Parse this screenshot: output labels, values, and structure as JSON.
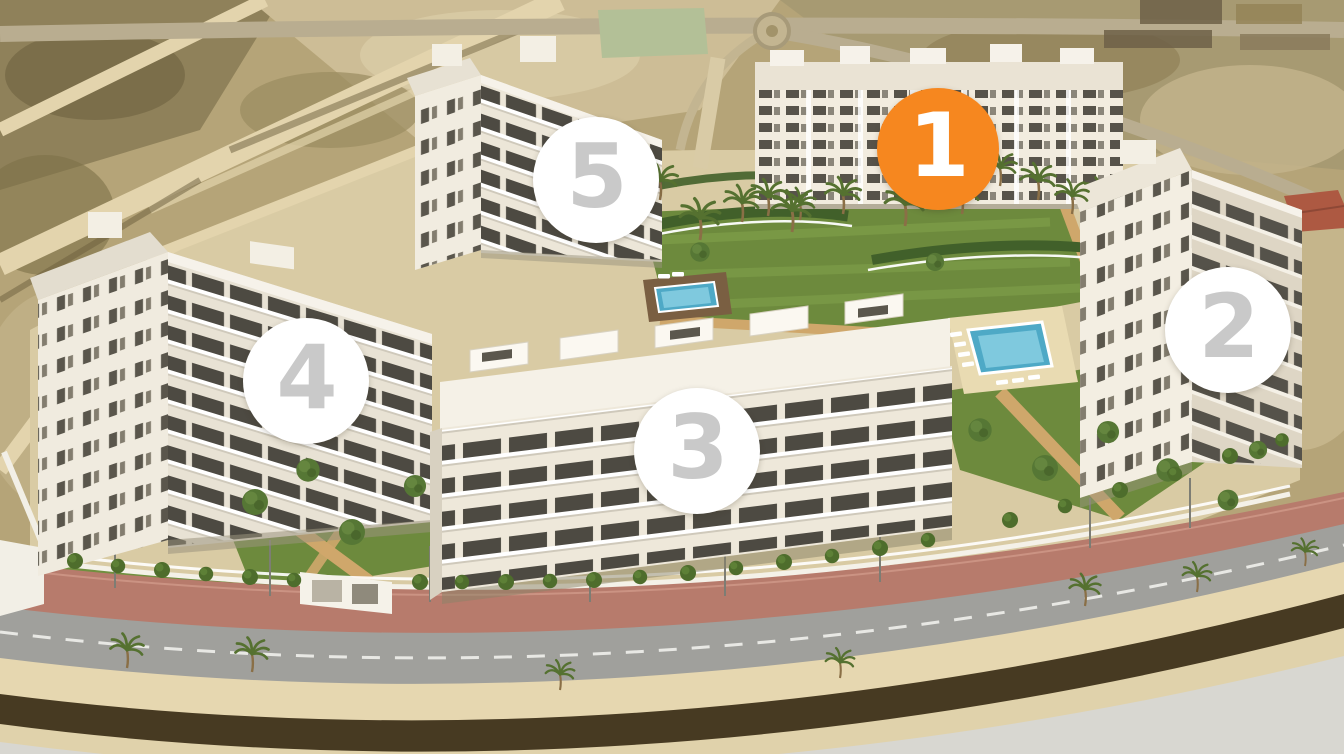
{
  "scene": {
    "alt": "Aerial 3D render of a white residential apartment complex with landscaped gardens, two swimming pools, palm trees and a perimeter road, with five numbered building markers"
  },
  "markers": [
    {
      "number": "1",
      "selected": true,
      "fill": "#f6871f",
      "number_color": "#ffffff"
    },
    {
      "number": "2",
      "selected": false,
      "fill": "#ffffff",
      "number_color": "#c9c9c9"
    },
    {
      "number": "3",
      "selected": false,
      "fill": "#ffffff",
      "number_color": "#c9c9c9"
    },
    {
      "number": "4",
      "selected": false,
      "fill": "#ffffff",
      "number_color": "#c9c9c9"
    },
    {
      "number": "5",
      "selected": false,
      "fill": "#ffffff",
      "number_color": "#c9c9c9"
    }
  ],
  "palette": {
    "accent_orange": "#f6871f",
    "marker_number_gray": "#c9c9c9",
    "terrain_sand": "#b5a478",
    "lawn_green": "#6d8a3d",
    "pool_blue": "#4ea9c6",
    "building_white": "#f1ecdf",
    "sidewalk_pink": "#b77b6c",
    "road_gray": "#a0a09c"
  }
}
